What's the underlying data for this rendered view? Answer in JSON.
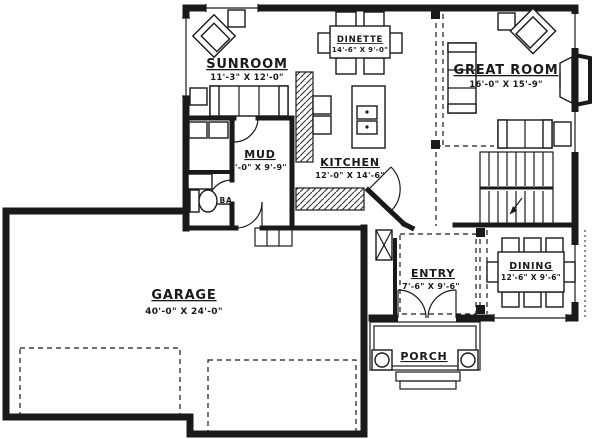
{
  "plan": {
    "type": "architectural-floor-plan",
    "colors": {
      "line": "#1a1a1a",
      "background": "#ffffff"
    },
    "rooms": {
      "sunroom": {
        "name": "SUNROOM",
        "dims": "11'-3\" X 12'-0\""
      },
      "dinette": {
        "name": "DINETTE",
        "dims": "14'-6\" X 9'-0\""
      },
      "great_room": {
        "name": "GREAT ROOM",
        "dims": "16'-0\" X 15'-9\""
      },
      "mud": {
        "name": "MUD",
        "dims": "6'-0\" X 9'-9\""
      },
      "kitchen": {
        "name": "KITCHEN",
        "dims": "12'-0\" X 14'-6\""
      },
      "bath": {
        "name": "BA"
      },
      "garage": {
        "name": "GARAGE",
        "dims": "40'-0\" X 24'-0\""
      },
      "entry": {
        "name": "ENTRY",
        "dims": "7'-6\" X 9'-6\""
      },
      "dining": {
        "name": "DINING",
        "dims": "12'-6\" X 9'-6\""
      },
      "porch": {
        "name": "PORCH"
      }
    }
  }
}
